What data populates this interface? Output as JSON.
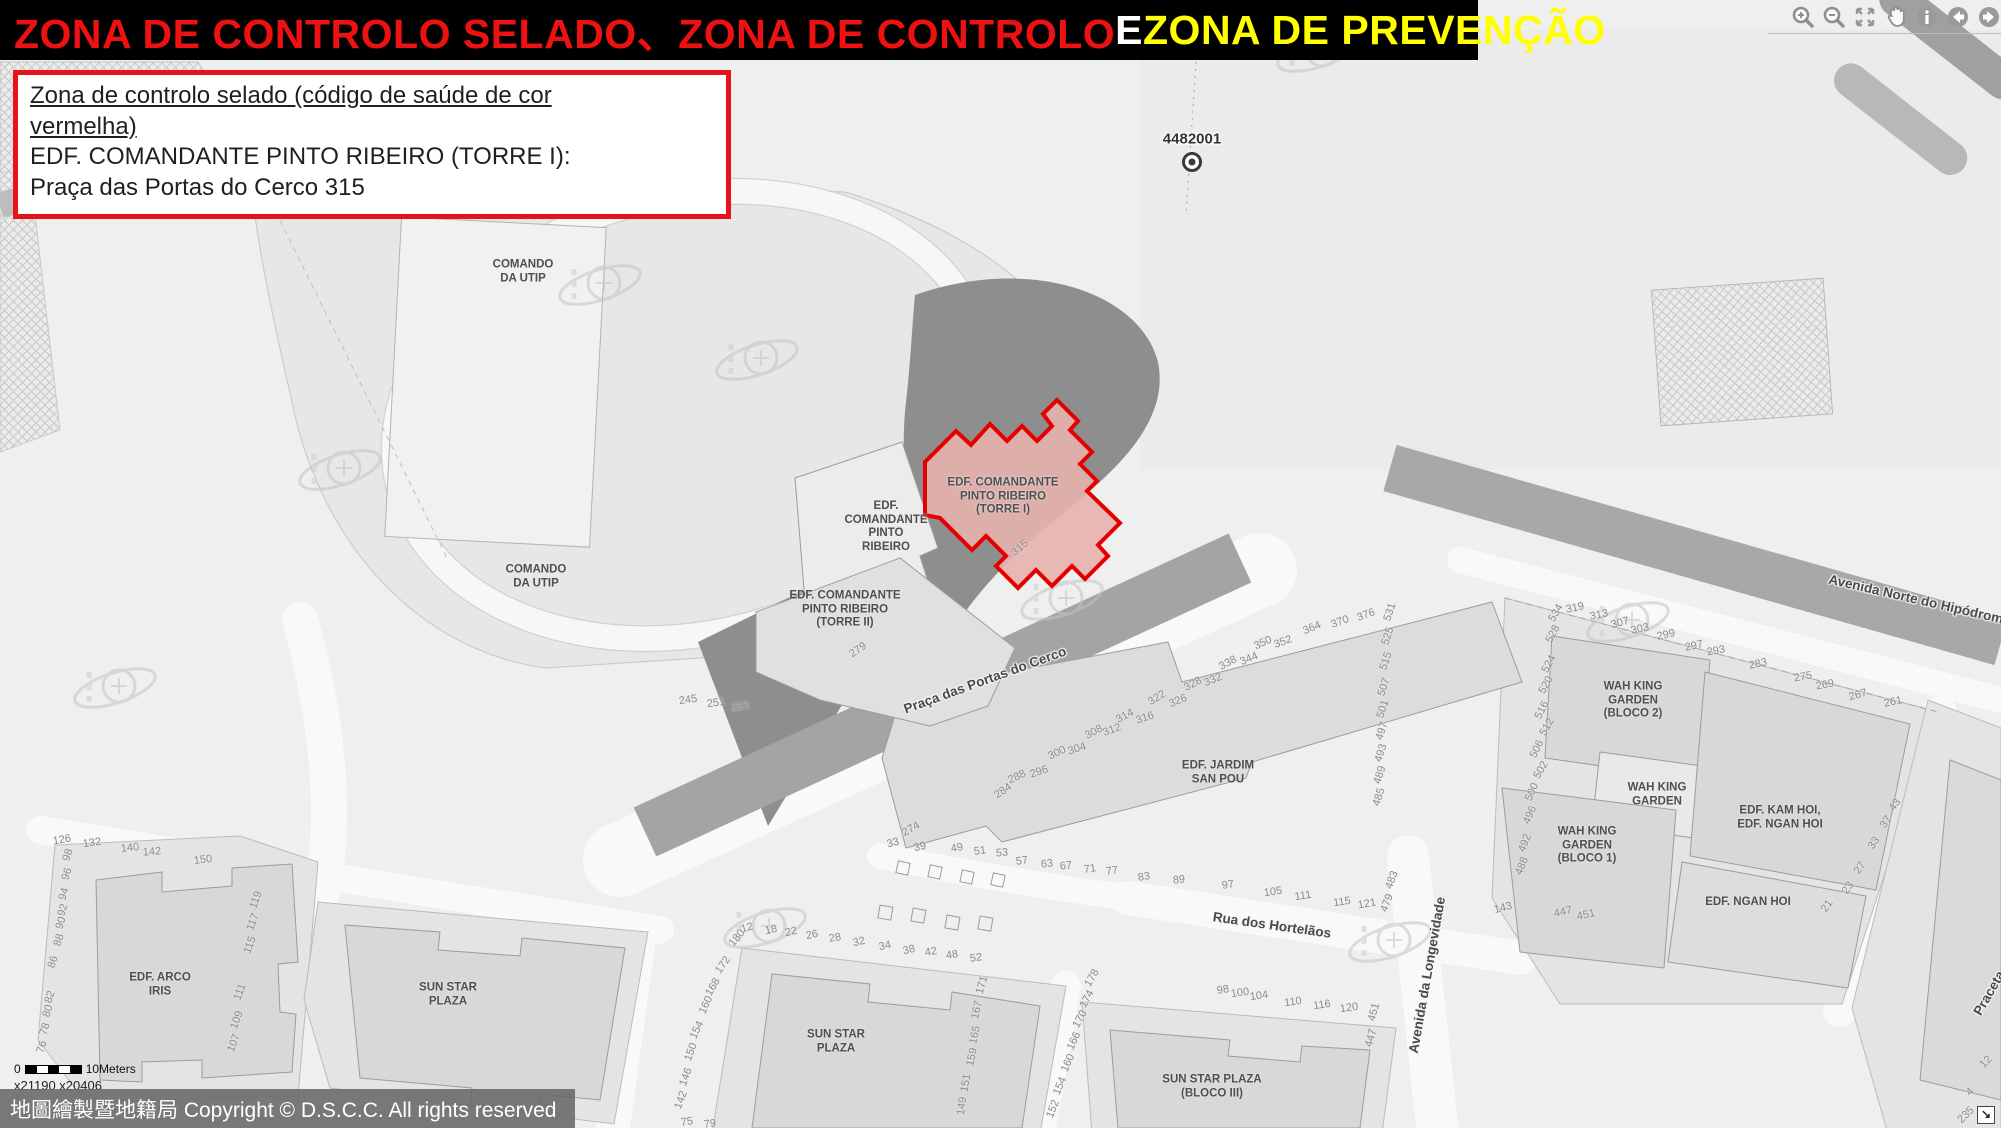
{
  "banner": {
    "seg1": "ZONA DE CONTROLO SELADO、ZONA DE CONTROLO ",
    "seg2": "E ",
    "seg3": "ZONA DE PREVENÇÃO"
  },
  "colors": {
    "banner_red": "#ee1111",
    "banner_yellow": "#ffff00",
    "banner_white": "#ffffff",
    "accent_red": "#e8121b",
    "highlight_stroke": "#e50000",
    "highlight_fill": "#e6b1ad"
  },
  "info_box": {
    "line1a": "Zona de controlo selado (código de saúde de cor",
    "line1b": "vermelha)",
    "line2": "EDF. COMANDANTE PINTO RIBEIRO (TORRE I):",
    "line3": "Praça das Portas do Cerco 315"
  },
  "toolbar": {
    "icons": [
      "zoom-in",
      "zoom-out",
      "zoom-extent",
      "pan",
      "identify",
      "previous-extent",
      "next-extent"
    ]
  },
  "map": {
    "marker": {
      "id": "4482001"
    },
    "building_labels": [
      {
        "lines": [
          "COMANDO",
          "DA UTIP"
        ],
        "x": 523,
        "y": 272
      },
      {
        "lines": [
          "COMANDO",
          "DA UTIP"
        ],
        "x": 536,
        "y": 577
      },
      {
        "lines": [
          "EDF.",
          "COMANDANTE",
          "PINTO",
          "RIBEIRO"
        ],
        "x": 886,
        "y": 527
      },
      {
        "lines": [
          "EDF. COMANDANTE",
          "PINTO RIBEIRO",
          "(TORRE I)"
        ],
        "x": 1003,
        "y": 497
      },
      {
        "lines": [
          "EDF. COMANDANTE",
          "PINTO RIBEIRO",
          "(TORRE II)"
        ],
        "x": 845,
        "y": 610
      },
      {
        "lines": [
          "EDF. JARDIM",
          "SAN POU"
        ],
        "x": 1218,
        "y": 773
      },
      {
        "lines": [
          "SUN STAR",
          "PLAZA"
        ],
        "x": 448,
        "y": 995
      },
      {
        "lines": [
          "SUN STAR",
          "PLAZA"
        ],
        "x": 836,
        "y": 1042
      },
      {
        "lines": [
          "SUN STAR PLAZA",
          "(BLOCO III)"
        ],
        "x": 1212,
        "y": 1087
      },
      {
        "lines": [
          "EDF. ARCO",
          "IRIS"
        ],
        "x": 160,
        "y": 985
      },
      {
        "lines": [
          "WAH KING",
          "GARDEN",
          "(BLOCO 2)"
        ],
        "x": 1633,
        "y": 701
      },
      {
        "lines": [
          "WAH KING",
          "GARDEN"
        ],
        "x": 1657,
        "y": 795
      },
      {
        "lines": [
          "WAH KING",
          "GARDEN",
          "(BLOCO 1)"
        ],
        "x": 1587,
        "y": 846
      },
      {
        "lines": [
          "EDF. KAM HOI,",
          "EDF. NGAN HOI"
        ],
        "x": 1780,
        "y": 818
      },
      {
        "lines": [
          "EDF. NGAN HOI"
        ],
        "x": 1748,
        "y": 903
      }
    ],
    "street_labels": [
      {
        "text": "Praça das Portas do Cerco",
        "x": 985,
        "y": 680,
        "r": -20
      },
      {
        "text": "Rua dos Hortelãos",
        "x": 1272,
        "y": 925,
        "r": 8
      },
      {
        "text": "Avenida da Longevidade",
        "x": 1427,
        "y": 975,
        "r": -80
      },
      {
        "text": "Avenida Norte do Hipódromo",
        "x": 1920,
        "y": 600,
        "r": 13
      },
      {
        "text": "Praceta",
        "x": 1989,
        "y": 993,
        "r": -60
      }
    ],
    "house_numbers": [
      {
        "t": "315",
        "x": 1020,
        "y": 548,
        "r": -40
      },
      {
        "t": "279",
        "x": 858,
        "y": 650,
        "r": -35
      },
      {
        "t": "245",
        "x": 688,
        "y": 700,
        "r": -8
      },
      {
        "t": "251",
        "x": 716,
        "y": 703,
        "r": -8
      },
      {
        "t": "253",
        "x": 740,
        "y": 707,
        "r": -8
      },
      {
        "t": "284",
        "x": 1003,
        "y": 791,
        "r": -35
      },
      {
        "t": "288",
        "x": 1017,
        "y": 777,
        "r": -25
      },
      {
        "t": "296",
        "x": 1039,
        "y": 772,
        "r": -18
      },
      {
        "t": "300",
        "x": 1057,
        "y": 753,
        "r": -25
      },
      {
        "t": "304",
        "x": 1077,
        "y": 749,
        "r": -18
      },
      {
        "t": "308",
        "x": 1094,
        "y": 732,
        "r": -28
      },
      {
        "t": "312",
        "x": 1112,
        "y": 730,
        "r": -20
      },
      {
        "t": "314",
        "x": 1125,
        "y": 716,
        "r": -28
      },
      {
        "t": "316",
        "x": 1145,
        "y": 718,
        "r": -18
      },
      {
        "t": "322",
        "x": 1157,
        "y": 698,
        "r": -32
      },
      {
        "t": "326",
        "x": 1178,
        "y": 701,
        "r": -22
      },
      {
        "t": "328",
        "x": 1193,
        "y": 684,
        "r": -28
      },
      {
        "t": "332",
        "x": 1213,
        "y": 680,
        "r": -22
      },
      {
        "t": "338",
        "x": 1228,
        "y": 663,
        "r": -28
      },
      {
        "t": "344",
        "x": 1249,
        "y": 659,
        "r": -22
      },
      {
        "t": "350",
        "x": 1263,
        "y": 643,
        "r": -25
      },
      {
        "t": "352",
        "x": 1283,
        "y": 642,
        "r": -20
      },
      {
        "t": "364",
        "x": 1312,
        "y": 628,
        "r": -22
      },
      {
        "t": "370",
        "x": 1340,
        "y": 622,
        "r": -20
      },
      {
        "t": "376",
        "x": 1366,
        "y": 615,
        "r": -20
      },
      {
        "t": "33",
        "x": 893,
        "y": 843,
        "r": -15
      },
      {
        "t": "39",
        "x": 920,
        "y": 847,
        "r": -12
      },
      {
        "t": "274",
        "x": 911,
        "y": 829,
        "r": -30
      },
      {
        "t": "49",
        "x": 957,
        "y": 848,
        "r": -10
      },
      {
        "t": "51",
        "x": 980,
        "y": 851,
        "r": -8
      },
      {
        "t": "53",
        "x": 1002,
        "y": 853,
        "r": -6
      },
      {
        "t": "57",
        "x": 1022,
        "y": 861,
        "r": -8
      },
      {
        "t": "63",
        "x": 1047,
        "y": 864,
        "r": -6
      },
      {
        "t": "67",
        "x": 1066,
        "y": 866,
        "r": -6
      },
      {
        "t": "71",
        "x": 1090,
        "y": 869,
        "r": -8
      },
      {
        "t": "77",
        "x": 1112,
        "y": 871,
        "r": -8
      },
      {
        "t": "83",
        "x": 1144,
        "y": 877,
        "r": -8
      },
      {
        "t": "89",
        "x": 1179,
        "y": 880,
        "r": -6
      },
      {
        "t": "97",
        "x": 1228,
        "y": 885,
        "r": -8
      },
      {
        "t": "105",
        "x": 1273,
        "y": 892,
        "r": -8
      },
      {
        "t": "111",
        "x": 1303,
        "y": 896,
        "r": -8
      },
      {
        "t": "115",
        "x": 1342,
        "y": 902,
        "r": -8
      },
      {
        "t": "121",
        "x": 1367,
        "y": 904,
        "r": -10
      },
      {
        "t": "531",
        "x": 1390,
        "y": 612,
        "r": -72
      },
      {
        "t": "525",
        "x": 1388,
        "y": 636,
        "r": -72
      },
      {
        "t": "515",
        "x": 1386,
        "y": 661,
        "r": -72
      },
      {
        "t": "507",
        "x": 1384,
        "y": 687,
        "r": -72
      },
      {
        "t": "501",
        "x": 1383,
        "y": 709,
        "r": -72
      },
      {
        "t": "497",
        "x": 1382,
        "y": 731,
        "r": -72
      },
      {
        "t": "493",
        "x": 1381,
        "y": 753,
        "r": -72
      },
      {
        "t": "489",
        "x": 1380,
        "y": 775,
        "r": -72
      },
      {
        "t": "485",
        "x": 1379,
        "y": 797,
        "r": -72
      },
      {
        "t": "483",
        "x": 1392,
        "y": 880,
        "r": -70
      },
      {
        "t": "479",
        "x": 1387,
        "y": 903,
        "r": -70
      },
      {
        "t": "451",
        "x": 1374,
        "y": 1012,
        "r": -75
      },
      {
        "t": "447",
        "x": 1371,
        "y": 1038,
        "r": -75
      },
      {
        "t": "98",
        "x": 1223,
        "y": 990,
        "r": -10
      },
      {
        "t": "100",
        "x": 1240,
        "y": 993,
        "r": -8
      },
      {
        "t": "104",
        "x": 1259,
        "y": 996,
        "r": -8
      },
      {
        "t": "110",
        "x": 1293,
        "y": 1002,
        "r": -8
      },
      {
        "t": "116",
        "x": 1322,
        "y": 1005,
        "r": -8
      },
      {
        "t": "120",
        "x": 1349,
        "y": 1008,
        "r": -8
      },
      {
        "t": "12",
        "x": 747,
        "y": 928,
        "r": -15
      },
      {
        "t": "18",
        "x": 771,
        "y": 930,
        "r": -12
      },
      {
        "t": "22",
        "x": 791,
        "y": 932,
        "r": -12
      },
      {
        "t": "26",
        "x": 812,
        "y": 935,
        "r": -12
      },
      {
        "t": "28",
        "x": 835,
        "y": 938,
        "r": -10
      },
      {
        "t": "32",
        "x": 859,
        "y": 942,
        "r": -12
      },
      {
        "t": "34",
        "x": 885,
        "y": 946,
        "r": -12
      },
      {
        "t": "38",
        "x": 909,
        "y": 950,
        "r": -12
      },
      {
        "t": "42",
        "x": 931,
        "y": 952,
        "r": -10
      },
      {
        "t": "48",
        "x": 952,
        "y": 955,
        "r": -8
      },
      {
        "t": "52",
        "x": 976,
        "y": 958,
        "r": -8
      },
      {
        "t": "180",
        "x": 737,
        "y": 938,
        "r": -50
      },
      {
        "t": "172",
        "x": 723,
        "y": 965,
        "r": -55
      },
      {
        "t": "168",
        "x": 713,
        "y": 987,
        "r": -60
      },
      {
        "t": "160",
        "x": 706,
        "y": 1005,
        "r": -65
      },
      {
        "t": "154",
        "x": 697,
        "y": 1030,
        "r": -65
      },
      {
        "t": "150",
        "x": 691,
        "y": 1052,
        "r": -70
      },
      {
        "t": "146",
        "x": 686,
        "y": 1077,
        "r": -70
      },
      {
        "t": "142",
        "x": 681,
        "y": 1100,
        "r": -70
      },
      {
        "t": "75",
        "x": 687,
        "y": 1122,
        "r": -8
      },
      {
        "t": "79",
        "x": 710,
        "y": 1124,
        "r": -8
      },
      {
        "t": "171",
        "x": 982,
        "y": 985,
        "r": -75
      },
      {
        "t": "167",
        "x": 977,
        "y": 1010,
        "r": -78
      },
      {
        "t": "165",
        "x": 975,
        "y": 1035,
        "r": -78
      },
      {
        "t": "159",
        "x": 972,
        "y": 1057,
        "r": -78
      },
      {
        "t": "151",
        "x": 966,
        "y": 1083,
        "r": -80
      },
      {
        "t": "149",
        "x": 962,
        "y": 1106,
        "r": -82
      },
      {
        "t": "178",
        "x": 1092,
        "y": 978,
        "r": -60
      },
      {
        "t": "174",
        "x": 1087,
        "y": 999,
        "r": -62
      },
      {
        "t": "170",
        "x": 1080,
        "y": 1019,
        "r": -62
      },
      {
        "t": "166",
        "x": 1074,
        "y": 1041,
        "r": -65
      },
      {
        "t": "160",
        "x": 1068,
        "y": 1063,
        "r": -65
      },
      {
        "t": "154",
        "x": 1060,
        "y": 1086,
        "r": -67
      },
      {
        "t": "152",
        "x": 1053,
        "y": 1109,
        "r": -68
      },
      {
        "t": "126",
        "x": 62,
        "y": 840,
        "r": -10
      },
      {
        "t": "132",
        "x": 92,
        "y": 843,
        "r": -8
      },
      {
        "t": "140",
        "x": 130,
        "y": 848,
        "r": -6
      },
      {
        "t": "142",
        "x": 152,
        "y": 852,
        "r": -4
      },
      {
        "t": "150",
        "x": 203,
        "y": 860,
        "r": -6
      },
      {
        "t": "98",
        "x": 68,
        "y": 855,
        "r": -72
      },
      {
        "t": "96",
        "x": 67,
        "y": 874,
        "r": -72
      },
      {
        "t": "94",
        "x": 64,
        "y": 894,
        "r": -72
      },
      {
        "t": "92",
        "x": 63,
        "y": 910,
        "r": -72
      },
      {
        "t": "90",
        "x": 61,
        "y": 923,
        "r": -72
      },
      {
        "t": "88",
        "x": 59,
        "y": 940,
        "r": -72
      },
      {
        "t": "86",
        "x": 53,
        "y": 962,
        "r": -72
      },
      {
        "t": "82",
        "x": 50,
        "y": 997,
        "r": -72
      },
      {
        "t": "80",
        "x": 48,
        "y": 1011,
        "r": -72
      },
      {
        "t": "78",
        "x": 45,
        "y": 1029,
        "r": -72
      },
      {
        "t": "76",
        "x": 42,
        "y": 1047,
        "r": -72
      },
      {
        "t": "119",
        "x": 256,
        "y": 900,
        "r": -70
      },
      {
        "t": "117",
        "x": 253,
        "y": 922,
        "r": -70
      },
      {
        "t": "115",
        "x": 250,
        "y": 945,
        "r": -70
      },
      {
        "t": "111",
        "x": 240,
        "y": 992,
        "r": -70
      },
      {
        "t": "109",
        "x": 237,
        "y": 1020,
        "r": -70
      },
      {
        "t": "107",
        "x": 234,
        "y": 1043,
        "r": -70
      },
      {
        "t": "319",
        "x": 1575,
        "y": 608,
        "r": -12
      },
      {
        "t": "313",
        "x": 1599,
        "y": 615,
        "r": -12
      },
      {
        "t": "307",
        "x": 1620,
        "y": 623,
        "r": -15
      },
      {
        "t": "303",
        "x": 1640,
        "y": 629,
        "r": -12
      },
      {
        "t": "299",
        "x": 1666,
        "y": 635,
        "r": -12
      },
      {
        "t": "297",
        "x": 1694,
        "y": 646,
        "r": -12
      },
      {
        "t": "293",
        "x": 1716,
        "y": 651,
        "r": -10
      },
      {
        "t": "283",
        "x": 1758,
        "y": 664,
        "r": -12
      },
      {
        "t": "275",
        "x": 1803,
        "y": 677,
        "r": -10
      },
      {
        "t": "269",
        "x": 1825,
        "y": 685,
        "r": -10
      },
      {
        "t": "267",
        "x": 1858,
        "y": 695,
        "r": -15
      },
      {
        "t": "261",
        "x": 1893,
        "y": 702,
        "r": -12
      },
      {
        "t": "534",
        "x": 1556,
        "y": 613,
        "r": -60
      },
      {
        "t": "528",
        "x": 1553,
        "y": 634,
        "r": -62
      },
      {
        "t": "524",
        "x": 1549,
        "y": 664,
        "r": -62
      },
      {
        "t": "520",
        "x": 1546,
        "y": 685,
        "r": -62
      },
      {
        "t": "516",
        "x": 1542,
        "y": 710,
        "r": -64
      },
      {
        "t": "512",
        "x": 1547,
        "y": 727,
        "r": -60
      },
      {
        "t": "506",
        "x": 1537,
        "y": 749,
        "r": -64
      },
      {
        "t": "502",
        "x": 1541,
        "y": 770,
        "r": -60
      },
      {
        "t": "500",
        "x": 1532,
        "y": 792,
        "r": -66
      },
      {
        "t": "496",
        "x": 1530,
        "y": 815,
        "r": -66
      },
      {
        "t": "492",
        "x": 1525,
        "y": 843,
        "r": -68
      },
      {
        "t": "488",
        "x": 1522,
        "y": 866,
        "r": -68
      },
      {
        "t": "143",
        "x": 1503,
        "y": 908,
        "r": -15
      },
      {
        "t": "447",
        "x": 1563,
        "y": 912,
        "r": -12
      },
      {
        "t": "451",
        "x": 1586,
        "y": 915,
        "r": -12
      },
      {
        "t": "43",
        "x": 1895,
        "y": 805,
        "r": -55
      },
      {
        "t": "37",
        "x": 1886,
        "y": 822,
        "r": -55
      },
      {
        "t": "33",
        "x": 1874,
        "y": 843,
        "r": -55
      },
      {
        "t": "27",
        "x": 1860,
        "y": 868,
        "r": -55
      },
      {
        "t": "23",
        "x": 1848,
        "y": 888,
        "r": -55
      },
      {
        "t": "21",
        "x": 1827,
        "y": 906,
        "r": -55
      },
      {
        "t": "12",
        "x": 1986,
        "y": 1062,
        "r": -45
      },
      {
        "t": "4",
        "x": 1970,
        "y": 1092,
        "r": -45
      },
      {
        "t": "235",
        "x": 1966,
        "y": 1115,
        "r": -45
      }
    ]
  },
  "scale_bar": {
    "zero_label": "0",
    "distance_label": "10Meters",
    "coord_text": "x21190  x20406"
  },
  "copyright": "地圖繪製暨地籍局 Copyright © D.S.C.C. All rights reserved",
  "corner_control": {
    "glyph": "↘"
  }
}
